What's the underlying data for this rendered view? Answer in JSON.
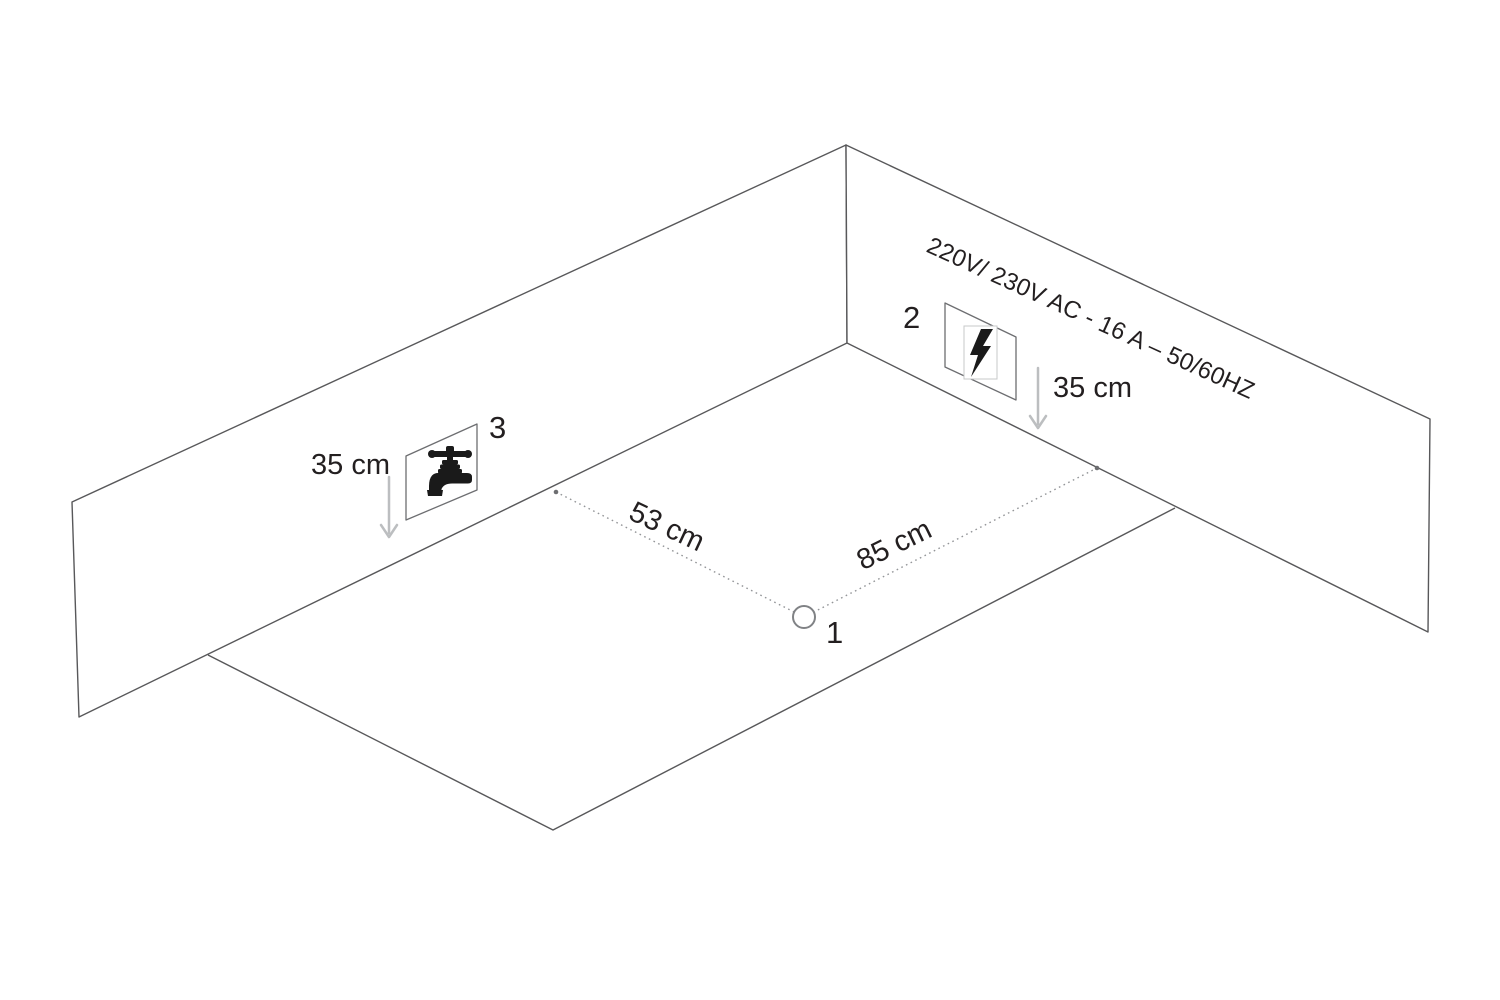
{
  "colors": {
    "background": "#ffffff",
    "wall_line": "#58585a",
    "detail_line": "#6d6e71",
    "dotted_line": "#939598",
    "arrow": "#bcbec0",
    "text": "#231f20",
    "icon": "#1a1a1a"
  },
  "wall_spec_label": "220V/ 230V AC - 16 A – 50/60HZ",
  "markers": {
    "floor_point": "1",
    "power_outlet": "2",
    "water_tap": "3"
  },
  "dimensions": {
    "floor_to_left_wall": "53 cm",
    "floor_to_right_wall": "85 cm",
    "tap_height": "35 cm",
    "outlet_height": "35 cm"
  },
  "icons": {
    "power_outlet": "lightning-bolt-icon",
    "water_supply": "water-tap-icon"
  }
}
